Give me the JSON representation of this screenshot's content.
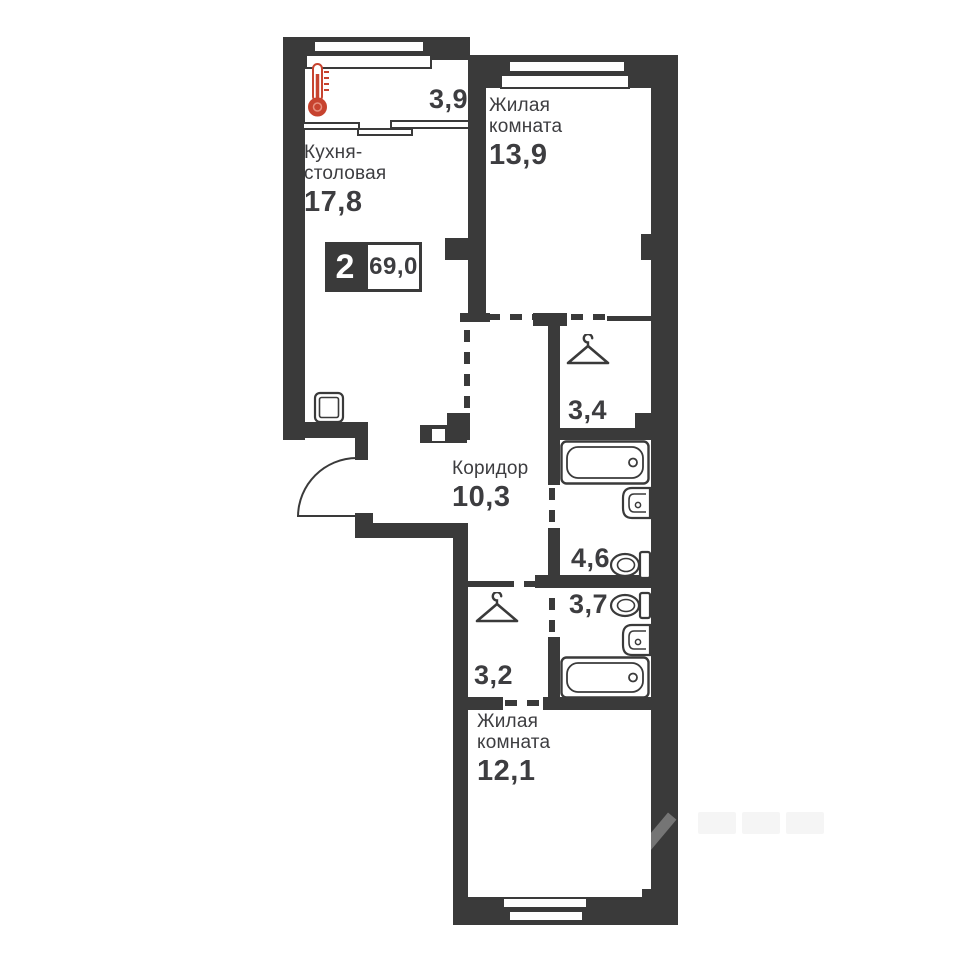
{
  "plan": {
    "badge": {
      "rooms": "2",
      "area": "69,0"
    },
    "rooms": {
      "balcony": {
        "area": "3,9"
      },
      "kitchen": {
        "name1": "Кухня-",
        "name2": "столовая",
        "area": "17,8"
      },
      "living1": {
        "name1": "Жилая",
        "name2": "комната",
        "area": "13,9"
      },
      "corridor": {
        "name1": "Коридор",
        "area": "10,3"
      },
      "wardrobe1": {
        "area": "3,4"
      },
      "bathroom1": {
        "area": "4,6"
      },
      "bathroom2": {
        "area": "3,7"
      },
      "wardrobe2": {
        "area": "3,2"
      },
      "living2": {
        "name1": "Жилая",
        "name2": "комната",
        "area": "12,1"
      }
    },
    "icons": [
      "thermometer-icon",
      "kitchen-sink-icon",
      "hanger-icon",
      "bathtub-icon",
      "sink-icon",
      "toilet-icon",
      "entrance-door-arc"
    ],
    "colors": {
      "wall": "#3a3a3a",
      "accent": "#c7432f",
      "ink": "#3d3d40"
    }
  }
}
